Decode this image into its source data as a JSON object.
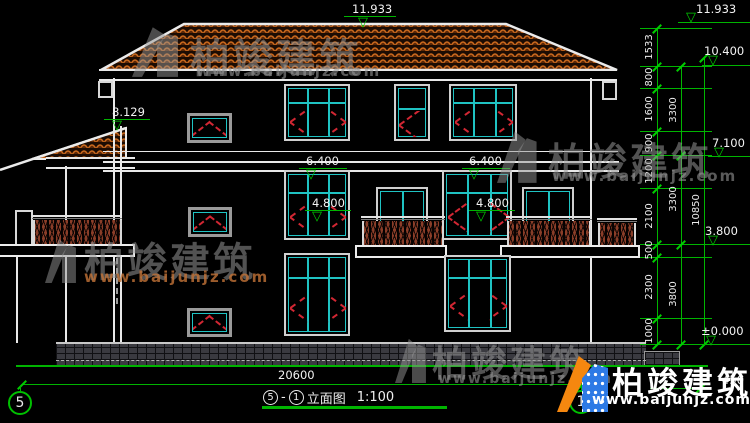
{
  "drawing": {
    "levels": {
      "ridge_center": "11.933",
      "ridge_right": "11.933",
      "eave": "10.400",
      "wing_eave": "8.129",
      "level_7100": "7.100",
      "slab_left": "6.400",
      "slab_right": "6.400",
      "window_left": "4.800",
      "window_right": "4.800",
      "level_3800": "3.800",
      "ground": "±0.000"
    },
    "dims": {
      "right_inner": [
        "1533",
        "800",
        "1600",
        "900",
        "1200",
        "2100",
        "500",
        "2300",
        "1000"
      ],
      "right_mid": [
        "3300",
        "3300",
        "3800"
      ],
      "right_outer": "10850",
      "bottom_width": "20600",
      "bottom_right": "450"
    },
    "axes": {
      "left": "5",
      "right": "1"
    },
    "title": {
      "axis_from": "5",
      "separator": "-",
      "axis_to": "1",
      "name": "立面图",
      "scale": "1:100"
    }
  },
  "watermark": {
    "brand": "柏竣建筑",
    "url": "www.baijunjz.com"
  },
  "logo": {
    "brand": "柏竣建筑",
    "url": "www.baijunjz.com"
  }
}
